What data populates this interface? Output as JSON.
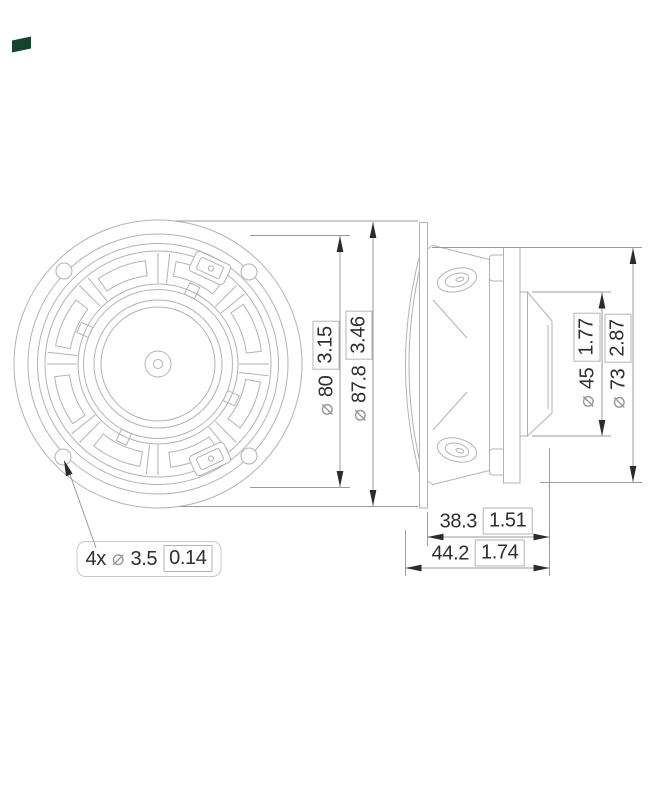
{
  "symbols": {
    "diameter": "⌀"
  },
  "colors": {
    "drawing_line": "#b3b3b3",
    "dimension_line": "#9b9b9b",
    "arrow": "#2c2c2c",
    "text": "#2e2e2e",
    "logo_green": "#15432b"
  },
  "dims": {
    "bolt_holes": {
      "count_prefix": "4x",
      "mm": "3.5",
      "inch": "0.14"
    },
    "bolt_circle": {
      "mm": "80",
      "inch": "3.15"
    },
    "overall_diameter": {
      "mm": "87.8",
      "inch": "3.46"
    },
    "magnet_rear": {
      "mm": "45",
      "inch": "1.77"
    },
    "magnet_front": {
      "mm": "73",
      "inch": "2.87"
    },
    "mounting_depth": {
      "mm": "38.3",
      "inch": "1.51"
    },
    "overall_depth": {
      "mm": "44.2",
      "inch": "1.74"
    }
  }
}
